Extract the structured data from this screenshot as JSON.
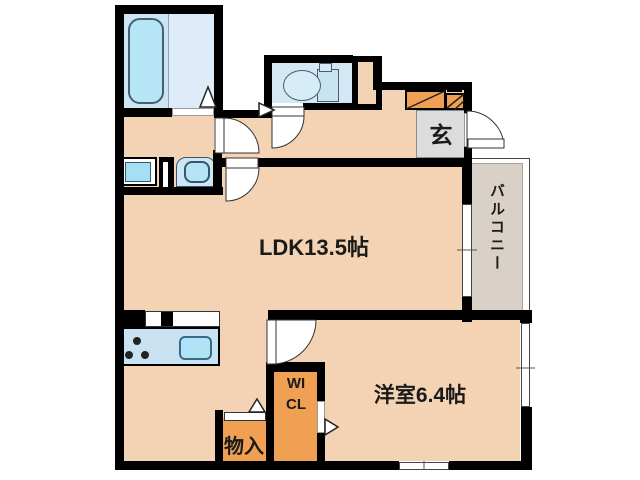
{
  "floorplan": {
    "title": "1LDK apartment floor plan",
    "labels": {
      "ldk": "LDK13.5帖",
      "bedroom": "洋室6.4帖",
      "balcony": "バルコニー",
      "entrance": "玄",
      "storage": "物入",
      "closet": "WICL"
    },
    "colors": {
      "wall": "#000000",
      "floor": "#f3d3b3",
      "closet": "#f0a052",
      "balcony": "#d9d0c7",
      "entrance_floor": "#dcdcdc",
      "water": "#cde4f2",
      "water_light": "#ddecf8",
      "fixture": "#b6e6f5"
    }
  }
}
